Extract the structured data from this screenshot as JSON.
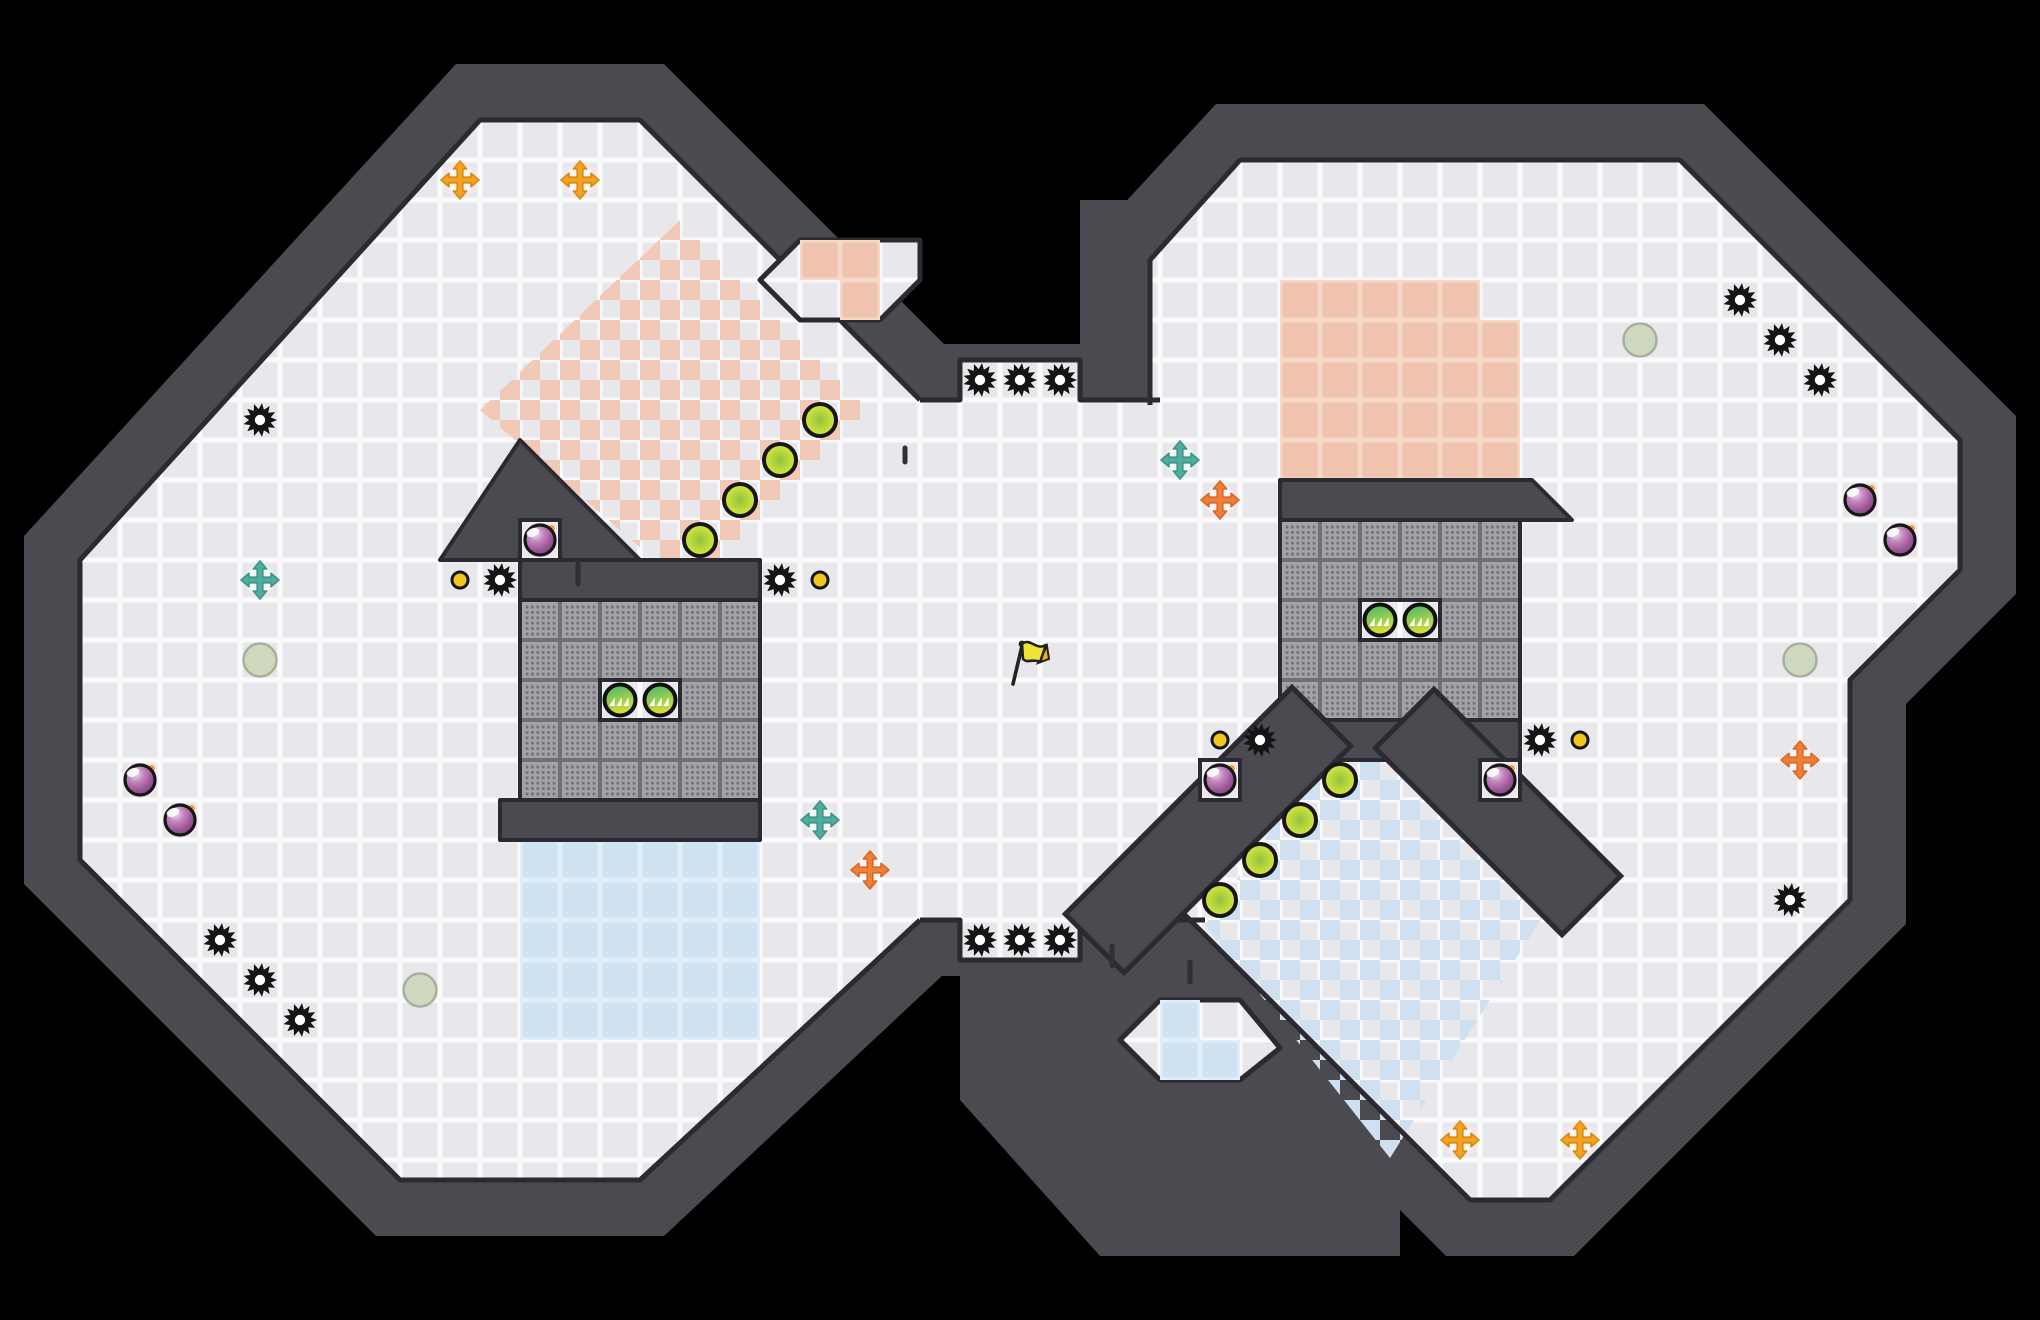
{
  "canvas": {
    "w": 2040,
    "h": 1320,
    "tile": 40
  },
  "palette": {
    "background": "#000000",
    "wall": "#4a4a50",
    "wall_edge": "#2a2a30",
    "floor_seam": "#fafafb",
    "floor_face": "#e8e8ec",
    "pink_face": "#f0c3ae",
    "pink_seam": "#f6d6c6",
    "blue_face": "#cfe2f1",
    "blue_seam": "#e2eef7",
    "checker_pink": "#f2c9b7",
    "checker_blue": "#cfe0f0",
    "grate_seam": "#6f6f75",
    "grate_face": "#a2a2a8",
    "grate_dot": "#73737a",
    "saw": "#141414",
    "saw_hole": "#fbfbfd",
    "coin": "#f4c51c",
    "bomb_body": "#9a5596",
    "bomb_spark": "#f5952c",
    "gold_orb_edge": "#e9ec38",
    "gold_orb_core": "#8ec63f",
    "pad_top": "#3fb56b",
    "pad_bottom": "#d9de3b",
    "arrow_gold": "#f2a41e",
    "arrow_teal": "#4fae9f",
    "arrow_orange": "#f08038",
    "pale_dot": "#cbd7b9",
    "flag_yellow": "#efe335",
    "flag_tip": "#f5a623",
    "outline": "#161616"
  },
  "terrain": {
    "silhouettes": [
      [
        456,
        64,
        664,
        64,
        976,
        376,
        976,
        944,
        664,
        1236,
        376,
        1236,
        24,
        884,
        24,
        536
      ],
      [
        824,
        344,
        1080,
        344,
        1080,
        200,
        1160,
        200,
        1160,
        976,
        824,
        976
      ],
      [
        1216,
        104,
        1704,
        104,
        2016,
        416,
        2016,
        594,
        1906,
        704,
        1906,
        924,
        1574,
        1256,
        1446,
        1256,
        1094,
        904,
        1094,
        236
      ],
      [
        960,
        920,
        1240,
        920,
        1400,
        1080,
        1400,
        1256,
        1100,
        1256,
        960,
        1100
      ]
    ],
    "floors": [
      [
        480,
        120,
        640,
        120,
        920,
        400,
        920,
        920,
        640,
        1180,
        400,
        1180,
        80,
        860,
        80,
        560
      ],
      [
        880,
        400,
        1180,
        400,
        1180,
        920,
        880,
        920
      ],
      [
        1240,
        160,
        1680,
        160,
        1960,
        440,
        1960,
        570,
        1850,
        680,
        1850,
        900,
        1550,
        1200,
        1470,
        1200,
        1150,
        880,
        1150,
        260
      ],
      [
        960,
        360,
        1080,
        360,
        1080,
        400,
        960,
        400
      ],
      [
        960,
        920,
        1080,
        920,
        1080,
        960,
        960,
        960
      ]
    ],
    "edges": [
      [
        920,
        920,
        640,
        1180,
        400,
        1180,
        80,
        860,
        80,
        560,
        480,
        120,
        640,
        120,
        920,
        400
      ],
      [
        920,
        400,
        960,
        400,
        960,
        360,
        1080,
        360,
        1080,
        400,
        1160,
        400
      ],
      [
        920,
        920,
        960,
        920,
        960,
        960,
        1080,
        960,
        1080,
        920,
        1205,
        920
      ],
      [
        1150,
        405,
        1150,
        260,
        1240,
        160,
        1680,
        160,
        1960,
        440,
        1960,
        570,
        1850,
        680,
        1850,
        900,
        1550,
        1200,
        1470,
        1200,
        1150,
        880
      ]
    ],
    "overlays": {
      "checker_pink_poly": [
        680,
        220,
        870,
        410,
        690,
        590,
        480,
        410
      ],
      "checker_blue_poly": [
        1320,
        760,
        1400,
        760,
        1548,
        908,
        1390,
        1158,
        1205,
        925
      ],
      "pink_rects": [
        [
          1280,
          280,
          200,
          40
        ],
        [
          1280,
          320,
          240,
          160
        ]
      ],
      "blue_rects": [
        [
          520,
          840,
          240,
          200
        ]
      ]
    },
    "structures": {
      "left_peak": [
        520,
        440,
        640,
        560,
        440,
        560
      ],
      "left_top_band": [
        520,
        560,
        240,
        40
      ],
      "left_grate": [
        520,
        600,
        240,
        200
      ],
      "left_bottom_band": [
        500,
        800,
        260,
        40
      ],
      "right_top_band": [
        1280,
        480,
        1532,
        480,
        1572,
        520,
        1280,
        520
      ],
      "right_grate": [
        1280,
        520,
        240,
        200
      ],
      "right_bottom_band": [
        1280,
        720,
        240,
        40
      ],
      "diag_bands": [
        [
          1292,
          746,
          1124,
          914
        ],
        [
          1434,
          748,
          1562,
          876
        ]
      ]
    },
    "pockets": [
      {
        "poly": [
          760,
          280,
          800,
          240,
          920,
          240,
          920,
          280,
          880,
          320,
          800,
          320
        ],
        "tiles": [
          [
            800,
            240,
            80,
            40
          ],
          [
            840,
            280,
            40,
            40
          ]
        ],
        "tile_color": "pink"
      },
      {
        "poly": [
          1120,
          1040,
          1160,
          1000,
          1240,
          1000,
          1280,
          1048,
          1240,
          1080,
          1160,
          1080
        ],
        "tiles": [
          [
            1160,
            1000,
            40,
            40
          ],
          [
            1160,
            1040,
            80,
            40
          ]
        ],
        "tile_color": "blue"
      }
    ],
    "alcoves": [
      [
        520,
        520,
        40,
        40
      ],
      [
        600,
        680,
        80,
        40
      ],
      [
        1360,
        600,
        80,
        40
      ],
      [
        1200,
        760,
        40,
        40
      ],
      [
        1480,
        760,
        40,
        40
      ]
    ],
    "wall_marks": [
      [
        578,
        564,
        578,
        584
      ],
      [
        1112,
        946,
        1112,
        966
      ],
      [
        1190,
        962,
        1190,
        982
      ],
      [
        905,
        448,
        905,
        462
      ]
    ]
  },
  "items": {
    "saws": [
      [
        260,
        420
      ],
      [
        500,
        580
      ],
      [
        780,
        580
      ],
      [
        980,
        380
      ],
      [
        1020,
        380
      ],
      [
        1060,
        380
      ],
      [
        980,
        940
      ],
      [
        1020,
        940
      ],
      [
        1060,
        940
      ],
      [
        220,
        940
      ],
      [
        260,
        980
      ],
      [
        300,
        1020
      ],
      [
        1740,
        300
      ],
      [
        1780,
        340
      ],
      [
        1820,
        380
      ],
      [
        1260,
        740
      ],
      [
        1540,
        740
      ],
      [
        1790,
        900
      ]
    ],
    "coins": [
      [
        460,
        580
      ],
      [
        820,
        580
      ],
      [
        1220,
        740
      ],
      [
        1580,
        740
      ]
    ],
    "bombs": [
      [
        540,
        540
      ],
      [
        140,
        780
      ],
      [
        180,
        820
      ],
      [
        1220,
        780
      ],
      [
        1500,
        780
      ],
      [
        1860,
        500
      ],
      [
        1900,
        540
      ]
    ],
    "gold_orbs": [
      [
        820,
        420
      ],
      [
        780,
        460
      ],
      [
        740,
        500
      ],
      [
        700,
        540
      ],
      [
        1340,
        780
      ],
      [
        1300,
        820
      ],
      [
        1260,
        860
      ],
      [
        1220,
        900
      ]
    ],
    "chevron_pads": [
      [
        620,
        700
      ],
      [
        660,
        700
      ],
      [
        1380,
        620
      ],
      [
        1420,
        620
      ]
    ],
    "arrows_gold": [
      [
        460,
        180
      ],
      [
        580,
        180
      ],
      [
        1460,
        1140
      ],
      [
        1580,
        1140
      ]
    ],
    "arrows_teal": [
      [
        260,
        580
      ],
      [
        820,
        820
      ],
      [
        1180,
        460
      ]
    ],
    "arrows_orange": [
      [
        870,
        870
      ],
      [
        1220,
        500
      ],
      [
        1800,
        760
      ]
    ],
    "pale_dots": [
      [
        260,
        660
      ],
      [
        420,
        990
      ],
      [
        1640,
        340
      ],
      [
        1800,
        660
      ]
    ],
    "flag": [
      [
        1020,
        660
      ]
    ]
  }
}
